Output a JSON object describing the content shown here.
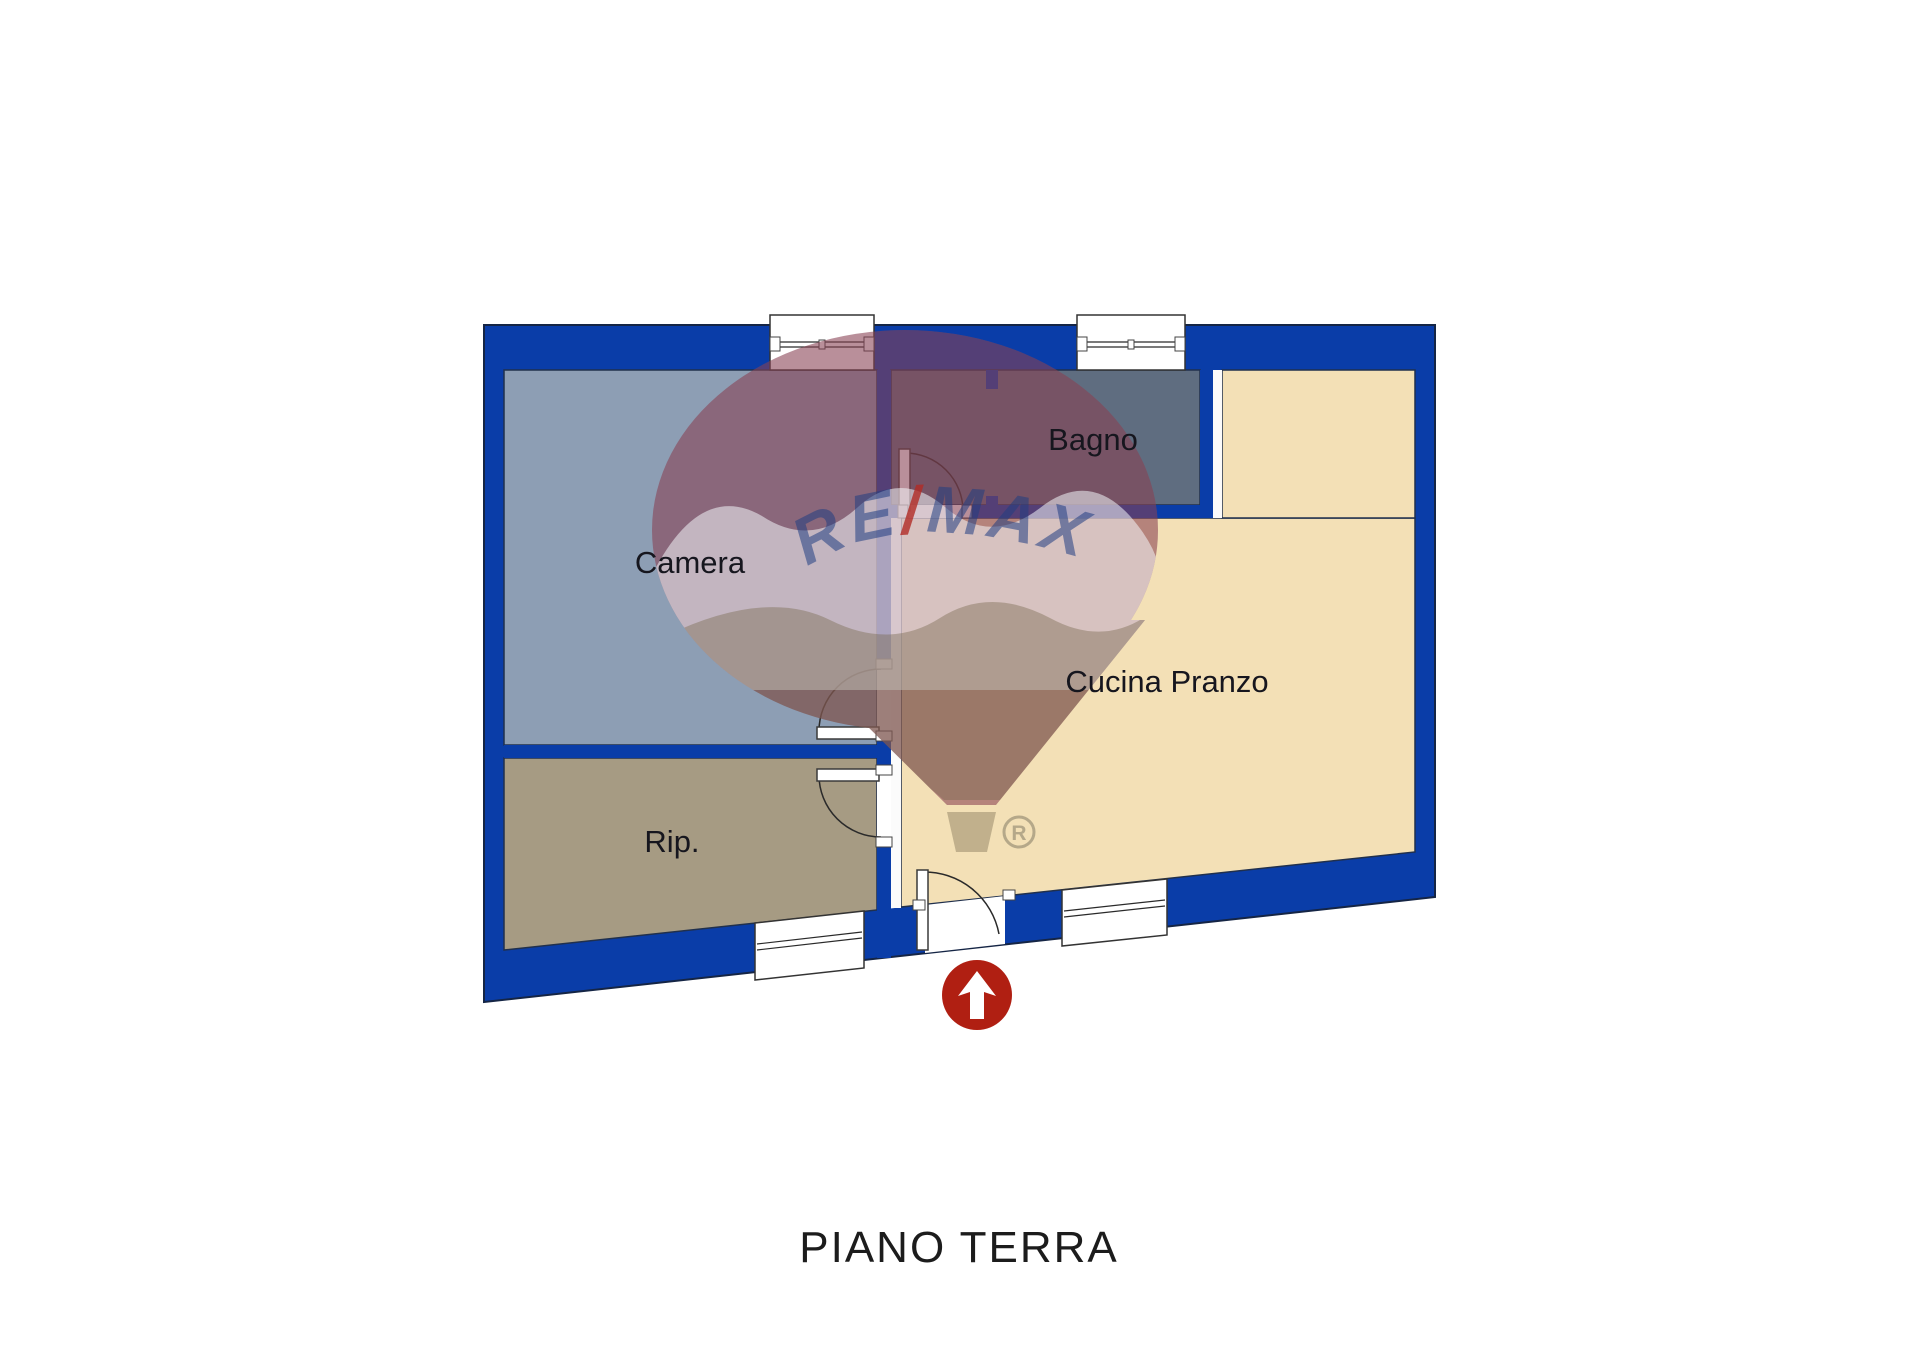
{
  "title": {
    "text": "PIANO TERRA"
  },
  "rooms": {
    "camera": {
      "label": "Camera"
    },
    "bagno": {
      "label": "Bagno"
    },
    "cucina": {
      "label": "Cucina Pranzo"
    },
    "rip": {
      "label": "Rip."
    }
  },
  "watermark": {
    "re": "RE",
    "slash": "/",
    "max": "MAX",
    "registered": "R"
  },
  "colors": {
    "wall": "#0a3da8",
    "camera_floor": "#8d9eb4",
    "rip_floor": "#a69b83",
    "bagno_floor": "#5f6d80",
    "cucina_floor": "#f3e0b6",
    "inner_white": "#ffffff",
    "strip_white": "#fbfbfb",
    "arrow_red": "#b01f12",
    "arrow_white": "#ffffff",
    "silhouette": "rgba(180,180,188,0.25)",
    "cap_red": "rgba(125,30,50,0.45)",
    "band_white": "rgba(242,245,250,0.55)",
    "cone_tan": "rgba(118,104,78,0.42)",
    "basket_tan": "rgba(118,104,78,0.40)",
    "remax_blue": "rgba(32,62,130,0.55)",
    "remax_red": "rgba(178,44,38,0.8)",
    "reg_gray": "rgba(130,122,100,0.55)"
  }
}
